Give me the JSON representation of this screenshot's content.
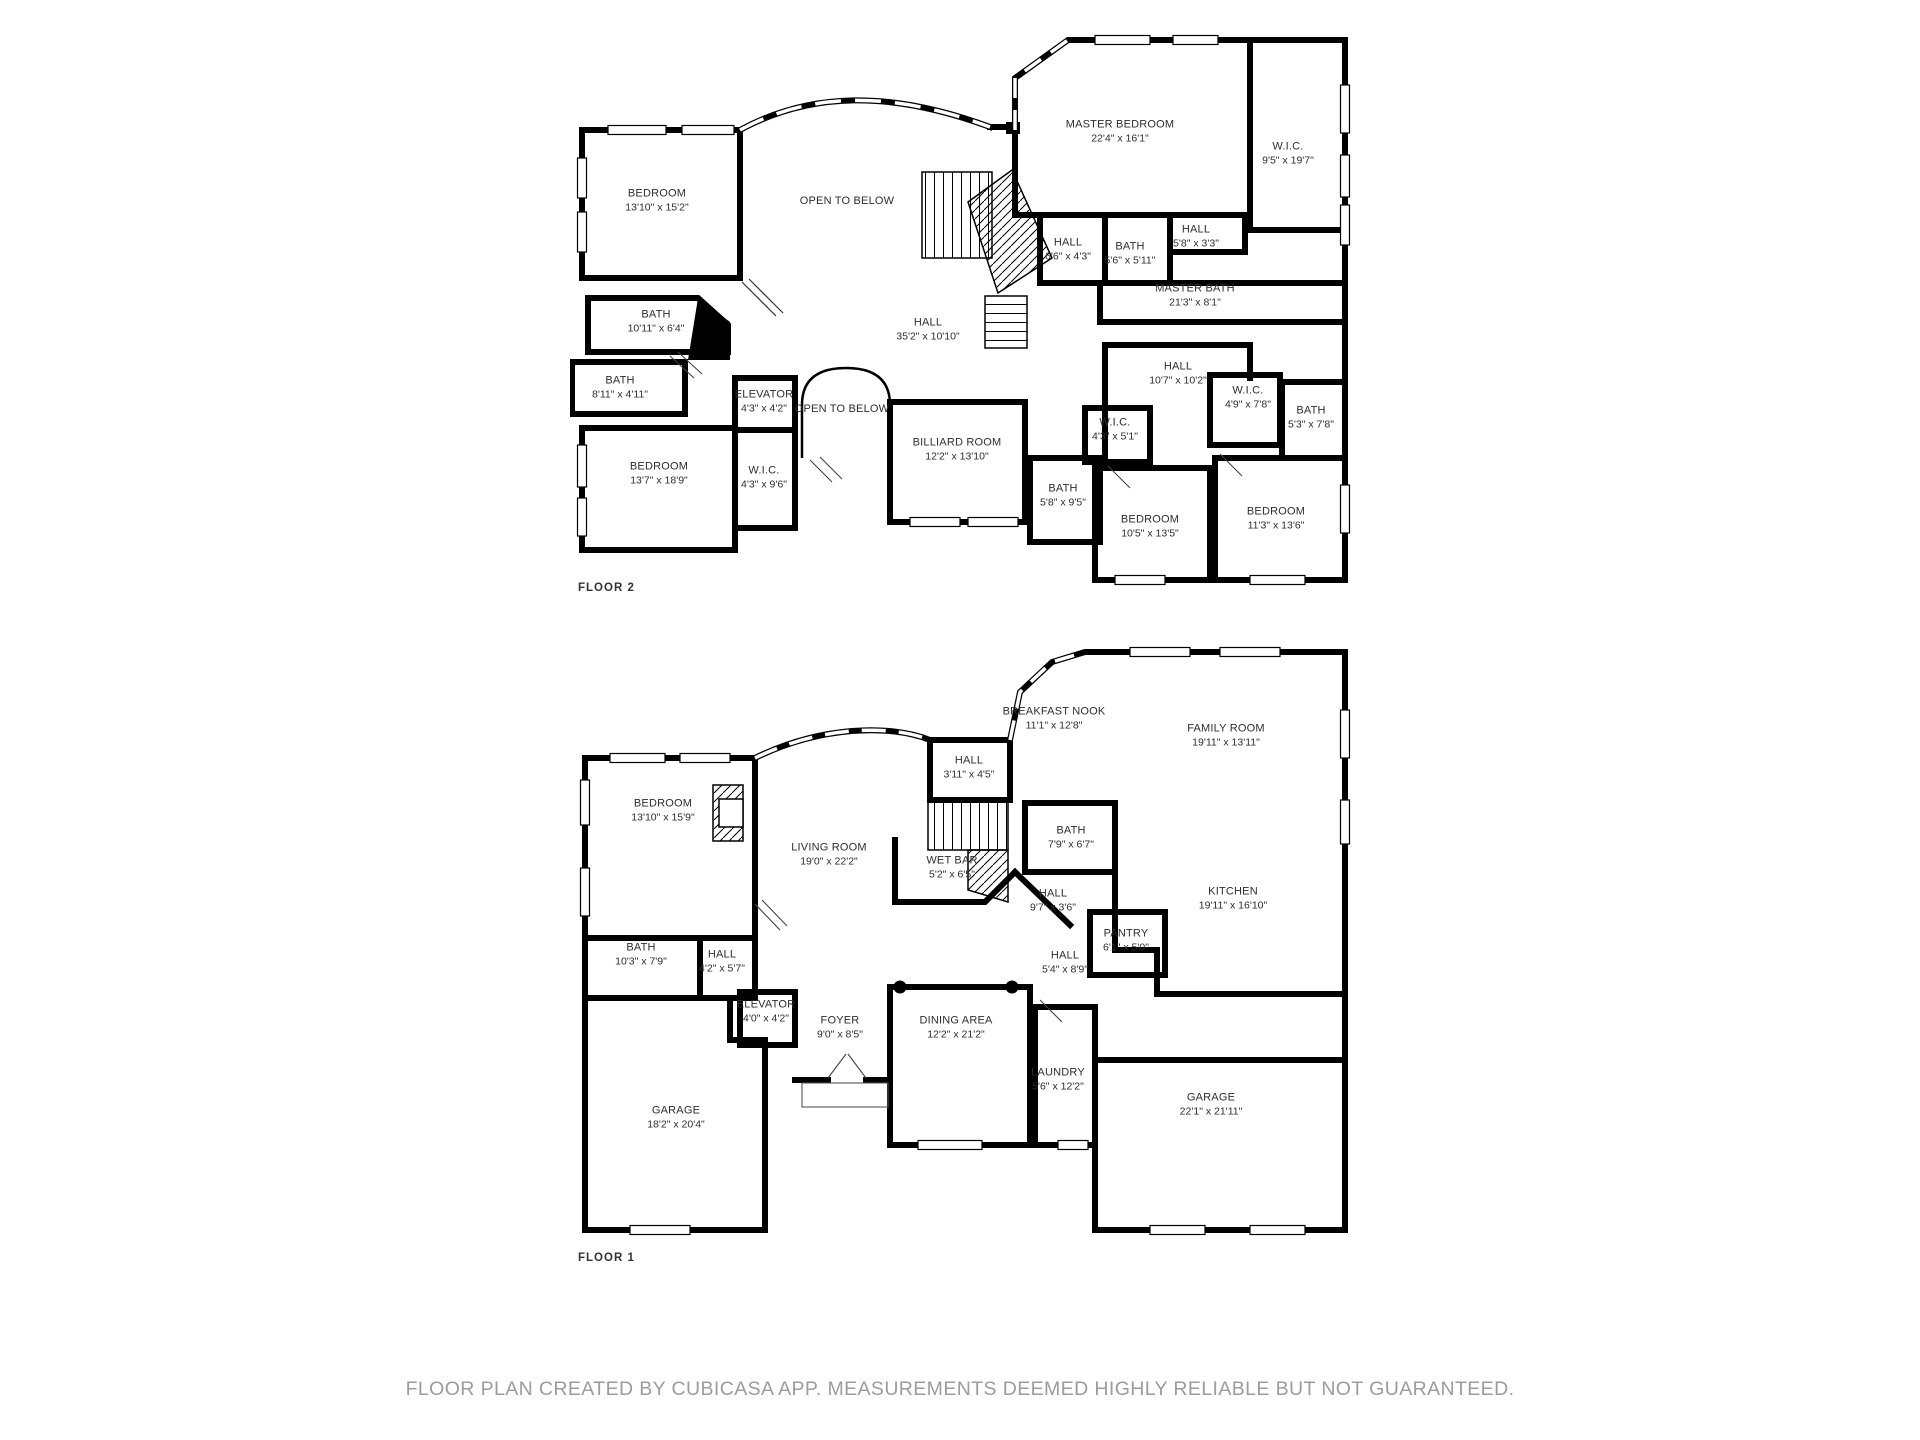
{
  "page": {
    "background": "#ffffff",
    "wall_color": "#000000",
    "label_color": "#2e2e2e",
    "footer_color": "#9c9c9c"
  },
  "floors": [
    {
      "label": "FLOOR 2",
      "rooms": [
        {
          "name": "BEDROOM",
          "dims": "13'10\" x 15'2\"",
          "x": 87,
          "y": 171
        },
        {
          "name": "OPEN TO BELOW",
          "dims": "",
          "x": 277,
          "y": 172
        },
        {
          "name": "MASTER BEDROOM",
          "dims": "22'4\" x 16'1\"",
          "x": 550,
          "y": 102
        },
        {
          "name": "W.I.C.",
          "dims": "9'5\" x 19'7\"",
          "x": 718,
          "y": 124
        },
        {
          "name": "HALL",
          "dims": "6'6\" x 4'3\"",
          "x": 498,
          "y": 220
        },
        {
          "name": "BATH",
          "dims": "5'6\" x 5'11\"",
          "x": 560,
          "y": 224
        },
        {
          "name": "HALL",
          "dims": "5'8\" x 3'3\"",
          "x": 626,
          "y": 207
        },
        {
          "name": "MASTER BATH",
          "dims": "21'3\" x 8'1\"",
          "x": 625,
          "y": 266
        },
        {
          "name": "BATH",
          "dims": "10'11\" x 6'4\"",
          "x": 86,
          "y": 292
        },
        {
          "name": "HALL",
          "dims": "35'2\" x 10'10\"",
          "x": 358,
          "y": 300
        },
        {
          "name": "BATH",
          "dims": "8'11\" x 4'11\"",
          "x": 50,
          "y": 358
        },
        {
          "name": "ELEVATOR",
          "dims": "4'3\" x 4'2\"",
          "x": 194,
          "y": 372
        },
        {
          "name": "OPEN TO BELOW",
          "dims": "",
          "x": 272,
          "y": 380
        },
        {
          "name": "BEDROOM",
          "dims": "13'7\" x 18'9\"",
          "x": 89,
          "y": 444
        },
        {
          "name": "W.I.C.",
          "dims": "4'3\" x 9'6\"",
          "x": 194,
          "y": 448
        },
        {
          "name": "BILLIARD ROOM",
          "dims": "12'2\" x 13'10\"",
          "x": 387,
          "y": 420
        },
        {
          "name": "HALL",
          "dims": "10'7\" x 10'2\"",
          "x": 608,
          "y": 344
        },
        {
          "name": "W.I.C.",
          "dims": "4'3\" x 5'1\"",
          "x": 545,
          "y": 400
        },
        {
          "name": "W.I.C.",
          "dims": "4'9\" x 7'8\"",
          "x": 678,
          "y": 368
        },
        {
          "name": "BATH",
          "dims": "5'3\" x 7'8\"",
          "x": 741,
          "y": 388
        },
        {
          "name": "BATH",
          "dims": "5'8\" x 9'5\"",
          "x": 493,
          "y": 466
        },
        {
          "name": "BEDROOM",
          "dims": "10'5\" x 13'5\"",
          "x": 580,
          "y": 497
        },
        {
          "name": "BEDROOM",
          "dims": "11'3\" x 13'6\"",
          "x": 706,
          "y": 489
        }
      ]
    },
    {
      "label": "FLOOR 1",
      "rooms": [
        {
          "name": "BREAKFAST NOOK",
          "dims": "11'1\" x 12'8\"",
          "x": 484,
          "y": 79
        },
        {
          "name": "FAMILY ROOM",
          "dims": "19'11\" x 13'11\"",
          "x": 656,
          "y": 96
        },
        {
          "name": "HALL",
          "dims": "3'11\" x 4'5\"",
          "x": 399,
          "y": 128
        },
        {
          "name": "BEDROOM",
          "dims": "13'10\" x 15'9\"",
          "x": 93,
          "y": 171
        },
        {
          "name": "LIVING ROOM",
          "dims": "19'0\" x 22'2\"",
          "x": 259,
          "y": 215
        },
        {
          "name": "WET BAR",
          "dims": "5'2\" x 6'5\"",
          "x": 382,
          "y": 228
        },
        {
          "name": "BATH",
          "dims": "7'9\" x 6'7\"",
          "x": 501,
          "y": 198
        },
        {
          "name": "HALL",
          "dims": "9'7\" x 3'6\"",
          "x": 483,
          "y": 261
        },
        {
          "name": "KITCHEN",
          "dims": "19'11\" x 16'10\"",
          "x": 663,
          "y": 259
        },
        {
          "name": "PANTRY",
          "dims": "6'1\" x 5'0\"",
          "x": 556,
          "y": 301
        },
        {
          "name": "HALL",
          "dims": "5'4\" x 8'9\"",
          "x": 495,
          "y": 323
        },
        {
          "name": "BATH",
          "dims": "10'3\" x 7'9\"",
          "x": 71,
          "y": 315
        },
        {
          "name": "HALL",
          "dims": "4'2\" x 5'7\"",
          "x": 152,
          "y": 322
        },
        {
          "name": "ELEVATOR",
          "dims": "4'0\" x 4'2\"",
          "x": 196,
          "y": 372
        },
        {
          "name": "FOYER",
          "dims": "9'0\" x 8'5\"",
          "x": 270,
          "y": 388
        },
        {
          "name": "DINING AREA",
          "dims": "12'2\" x 21'2\"",
          "x": 386,
          "y": 388
        },
        {
          "name": "LAUNDRY",
          "dims": "5'6\" x 12'2\"",
          "x": 488,
          "y": 440
        },
        {
          "name": "GARAGE",
          "dims": "18'2\" x 20'4\"",
          "x": 106,
          "y": 478
        },
        {
          "name": "GARAGE",
          "dims": "22'1\" x 21'11\"",
          "x": 641,
          "y": 465
        }
      ]
    }
  ],
  "footer": {
    "text": "FLOOR PLAN CREATED BY CUBICASA APP. MEASUREMENTS DEEMED HIGHLY RELIABLE BUT NOT GUARANTEED."
  }
}
